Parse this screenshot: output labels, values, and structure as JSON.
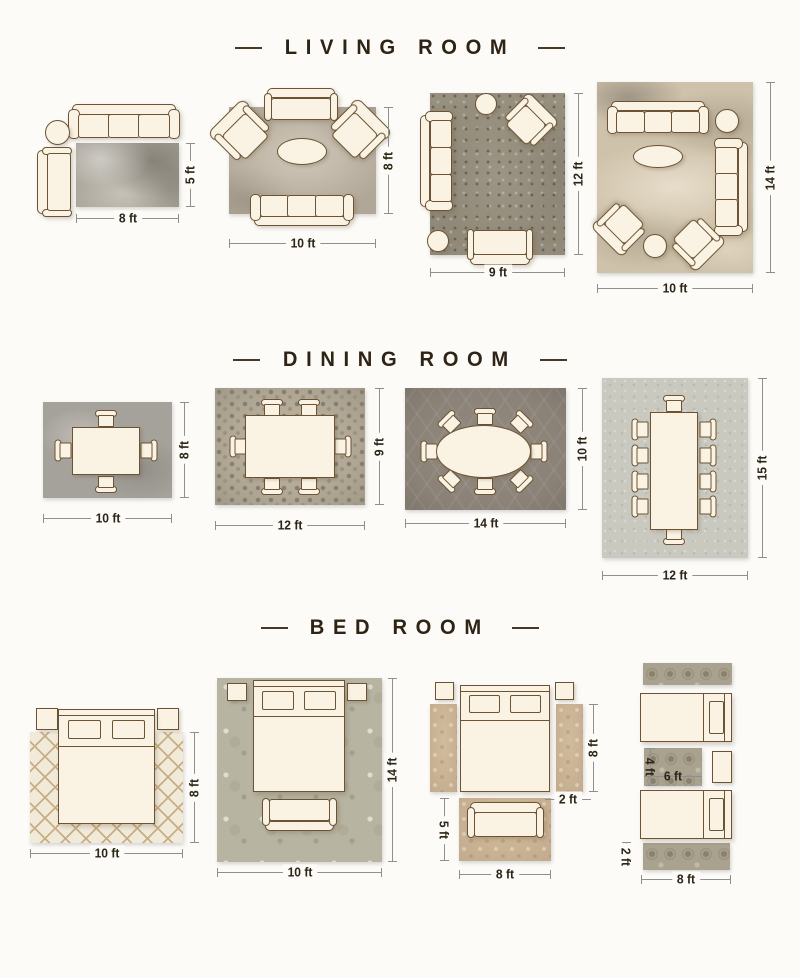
{
  "page": {
    "kind": "rug-size-guide-infographic"
  },
  "colors": {
    "background": "#fcfbf8",
    "furniture_outline": "#6b5334",
    "furniture_fill": "#faf3e3",
    "title_text": "#2e2315",
    "dimension_text": "#2c2517",
    "dimension_line": "#8f8f8f"
  },
  "sections": [
    {
      "title": "LIVING ROOM",
      "layouts": [
        {
          "w": "8 ft",
          "h": "5 ft"
        },
        {
          "w": "10 ft",
          "h": "8 ft"
        },
        {
          "w": "9 ft",
          "h": "12 ft"
        },
        {
          "w": "10 ft",
          "h": "14 ft"
        }
      ]
    },
    {
      "title": "DINING ROOM",
      "layouts": [
        {
          "w": "10 ft",
          "h": "8 ft"
        },
        {
          "w": "12 ft",
          "h": "9 ft"
        },
        {
          "w": "14 ft",
          "h": "10 ft"
        },
        {
          "w": "12 ft",
          "h": "15 ft"
        }
      ]
    },
    {
      "title": "BED ROOM",
      "layouts": [
        {
          "w": "10 ft",
          "h": "8 ft"
        },
        {
          "w": "10 ft",
          "h": "14 ft"
        },
        {
          "runner_h": "8 ft",
          "runner_w": "2 ft",
          "rug_h": "5 ft",
          "rug_w": "8 ft"
        },
        {
          "mid_h": "4 ft",
          "mid_w": "6 ft",
          "runner_h": "2 ft",
          "runner_w": "8 ft"
        }
      ]
    }
  ]
}
